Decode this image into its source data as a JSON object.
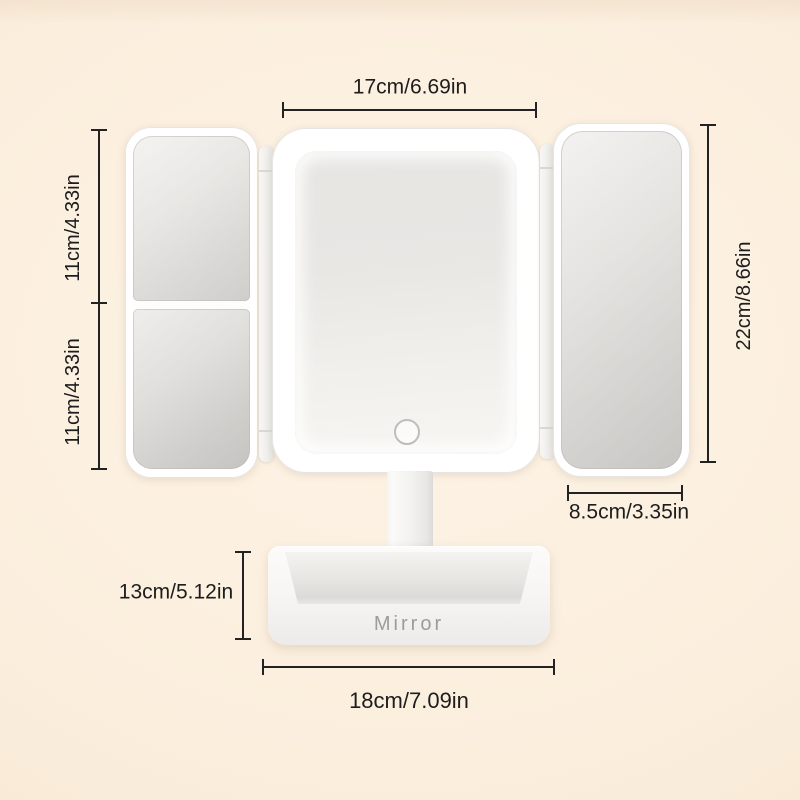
{
  "product": {
    "base_brand_label": "Mirror"
  },
  "annotations": {
    "top_width": "17cm/6.69in",
    "left_upper_height": "11cm/4.33in",
    "left_lower_height": "11cm/4.33in",
    "right_total_height": "22cm/8.66in",
    "side_panel_width": "8.5cm/3.35in",
    "stand_height": "13cm/5.12in",
    "base_width": "18cm/7.09in"
  },
  "colors": {
    "background": "#fbeedd",
    "dimension_line": "#222222",
    "label_text": "#1d1d1d",
    "frame_white": "#ffffff",
    "mirror_glass": "#d9d8d5",
    "base_label_text": "#9c9c9c"
  }
}
